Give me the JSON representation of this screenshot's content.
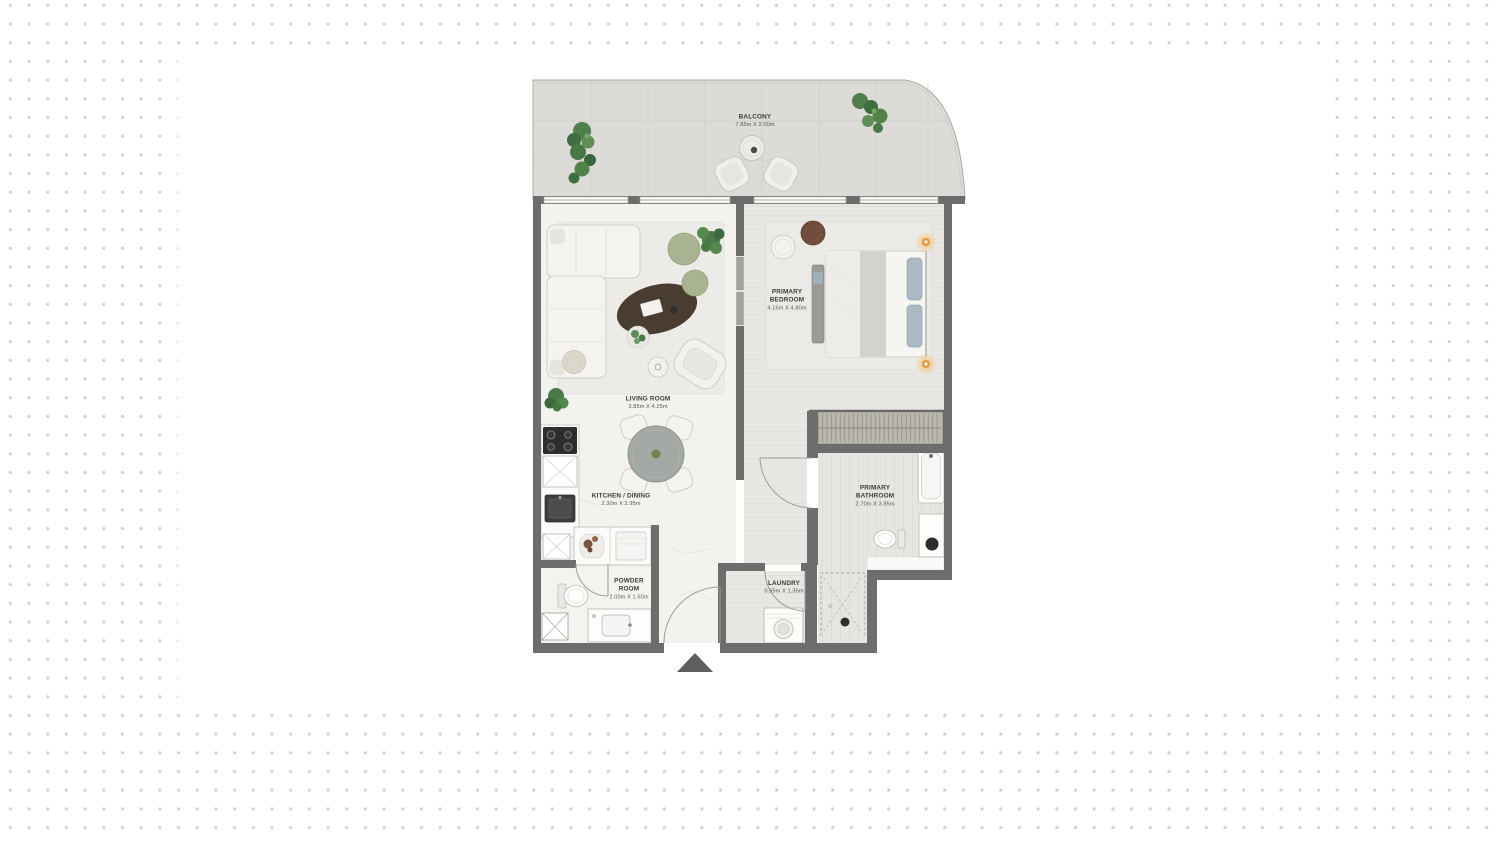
{
  "plan": {
    "palette": {
      "wall": "#6d6d6d",
      "balcony_floor": "#dcdbd7",
      "wood_floor": "#e9e7e3",
      "marble_floor": "#f3f2ef",
      "pouf_green": "#a9b291",
      "plant_green": "#4a7a49",
      "coffee_table_brown": "#493c30",
      "lamp_glow": "#eead52",
      "entry_marker": "#5f5f5f"
    },
    "rooms": {
      "balcony": {
        "label": "BALCONY",
        "dims": "7.85m X 2.00m"
      },
      "living_room": {
        "label": "LIVING ROOM",
        "dims": "3.85m X 4.25m"
      },
      "primary_bedroom": {
        "label_line1": "PRIMARY",
        "label_line2": "BEDROOM",
        "dims": "4.15m X 4.80m"
      },
      "kitchen_dining": {
        "label": "KITCHEN / DINING",
        "dims": "2.30m X 2.95m"
      },
      "powder_room": {
        "label_line1": "POWDER",
        "label_line2": "ROOM",
        "dims": "2.00m X 1.50m"
      },
      "laundry": {
        "label": "LAUNDRY",
        "dims": "0.95m X 1.35m"
      },
      "primary_bathroom": {
        "label_line1": "PRIMARY",
        "label_line2": "BATHROOM",
        "dims": "2.70m X 3.95m"
      }
    }
  }
}
